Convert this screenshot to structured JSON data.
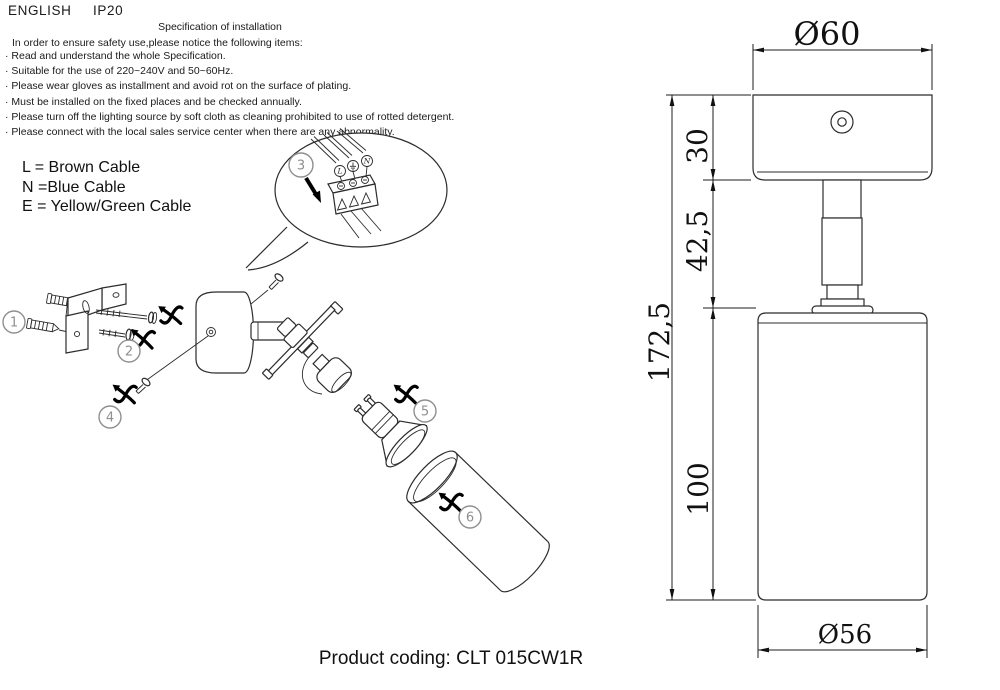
{
  "header": {
    "language": "ENGLISH",
    "ip_rating": "IP20"
  },
  "spec": {
    "title": "Specification of installation",
    "intro": "In order to ensure safety use,please notice the following items:",
    "items": [
      "· Read and understand the whole Specification.",
      "· Suitable for the use of 220~240V and 50~60Hz.",
      "· Please wear gloves as installment and avoid rot on the surface of plating.",
      "· Must be installed on the fixed places and be checked annually.",
      "· Please turn off the lighting source by soft cloth as cleaning prohibited to use of rotted detergent.",
      "· Please connect with the local sales service center when there are any abnormality."
    ]
  },
  "cable_legend": {
    "line_l": "L = Brown Cable",
    "line_n": "N =Blue Cable",
    "line_e": "E = Yellow/Green Cable"
  },
  "wiring_detail": {
    "step": "3",
    "terminal_left": "L",
    "terminal_middle": "⏚",
    "terminal_right": "N"
  },
  "assembly_steps": {
    "s1": "1",
    "s2": "2",
    "s4": "4",
    "s5": "5",
    "s6": "6"
  },
  "dimensions": {
    "top_diameter": "Ø60",
    "canopy_height": "30",
    "stem_height": "42,5",
    "total_height": "172,5",
    "body_height": "100",
    "body_diameter": "Ø56"
  },
  "footer": {
    "product_coding": "Product coding: CLT 015CW1R"
  }
}
